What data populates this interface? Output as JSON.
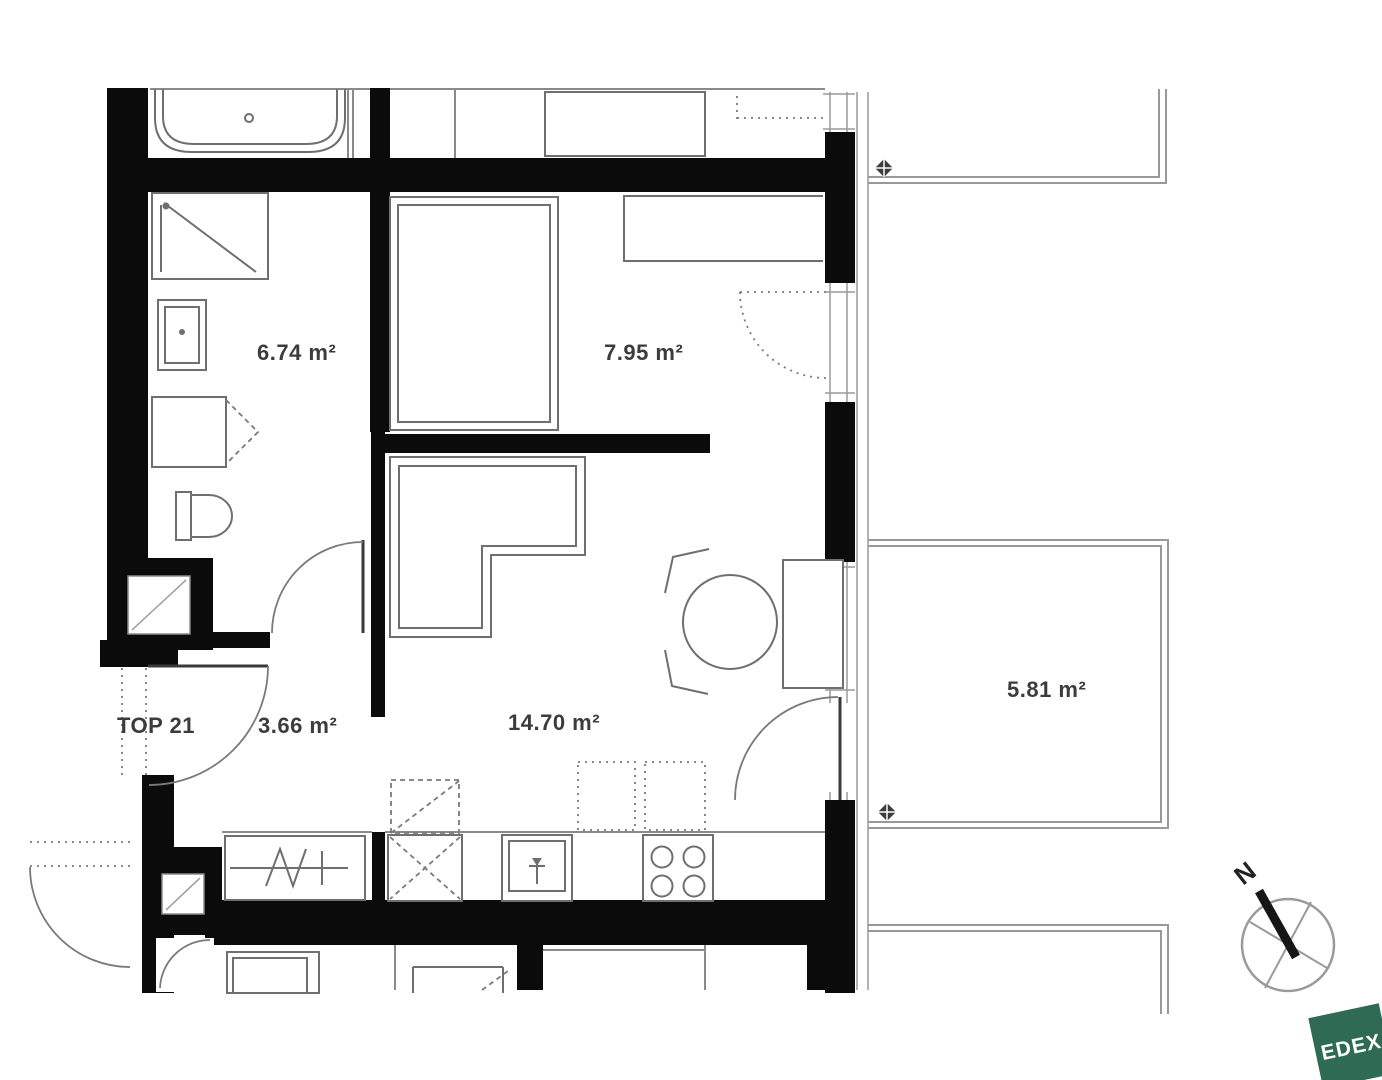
{
  "plan": {
    "unit_label": "TOP 21",
    "rooms": {
      "bathroom": {
        "name": "bathroom",
        "area": "6.74 m²"
      },
      "bedroom": {
        "name": "bedroom",
        "area": "7.95 m²"
      },
      "hallway": {
        "name": "hallway",
        "area": "3.66 m²"
      },
      "living_kitchen": {
        "name": "living-kitchen",
        "area": "14.70 m²"
      },
      "balcony": {
        "name": "balcony",
        "area": "5.81 m²"
      }
    },
    "compass": {
      "north": "N"
    },
    "logo": {
      "text": "EDEX",
      "color": "#2e6a54"
    },
    "style": {
      "wall_color": "#0b0b0b",
      "label_color": "#3c3c3c"
    }
  }
}
